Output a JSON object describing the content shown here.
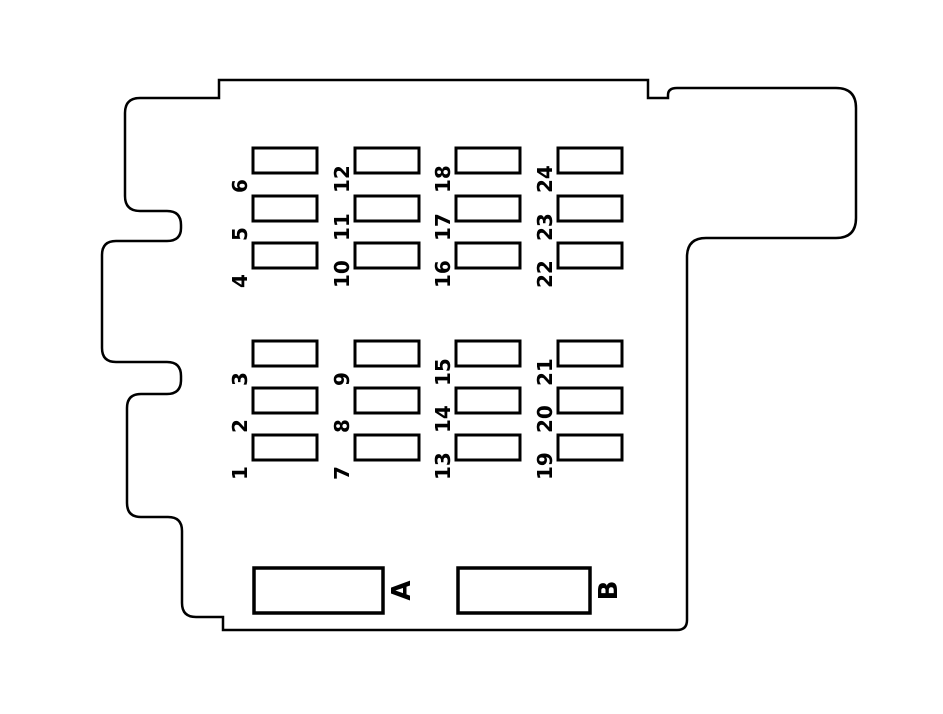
{
  "diagram": {
    "colors": {
      "background": "#ffffff",
      "line": "#000000"
    },
    "fuse_columns": [
      {
        "group": "upper",
        "labels_top_to_bottom": [
          "6",
          "5",
          "4"
        ]
      },
      {
        "group": "upper",
        "labels_top_to_bottom": [
          "12",
          "11",
          "10"
        ]
      },
      {
        "group": "upper",
        "labels_top_to_bottom": [
          "18",
          "17",
          "16"
        ]
      },
      {
        "group": "upper",
        "labels_top_to_bottom": [
          "24",
          "23",
          "22"
        ]
      },
      {
        "group": "lower",
        "labels_top_to_bottom": [
          "3",
          "2",
          "1"
        ]
      },
      {
        "group": "lower",
        "labels_top_to_bottom": [
          "9",
          "8",
          "7"
        ]
      },
      {
        "group": "lower",
        "labels_top_to_bottom": [
          "15",
          "14",
          "13"
        ]
      },
      {
        "group": "lower",
        "labels_top_to_bottom": [
          "21",
          "20",
          "19"
        ]
      }
    ],
    "connectors": [
      {
        "label": "A"
      },
      {
        "label": "B"
      }
    ]
  }
}
